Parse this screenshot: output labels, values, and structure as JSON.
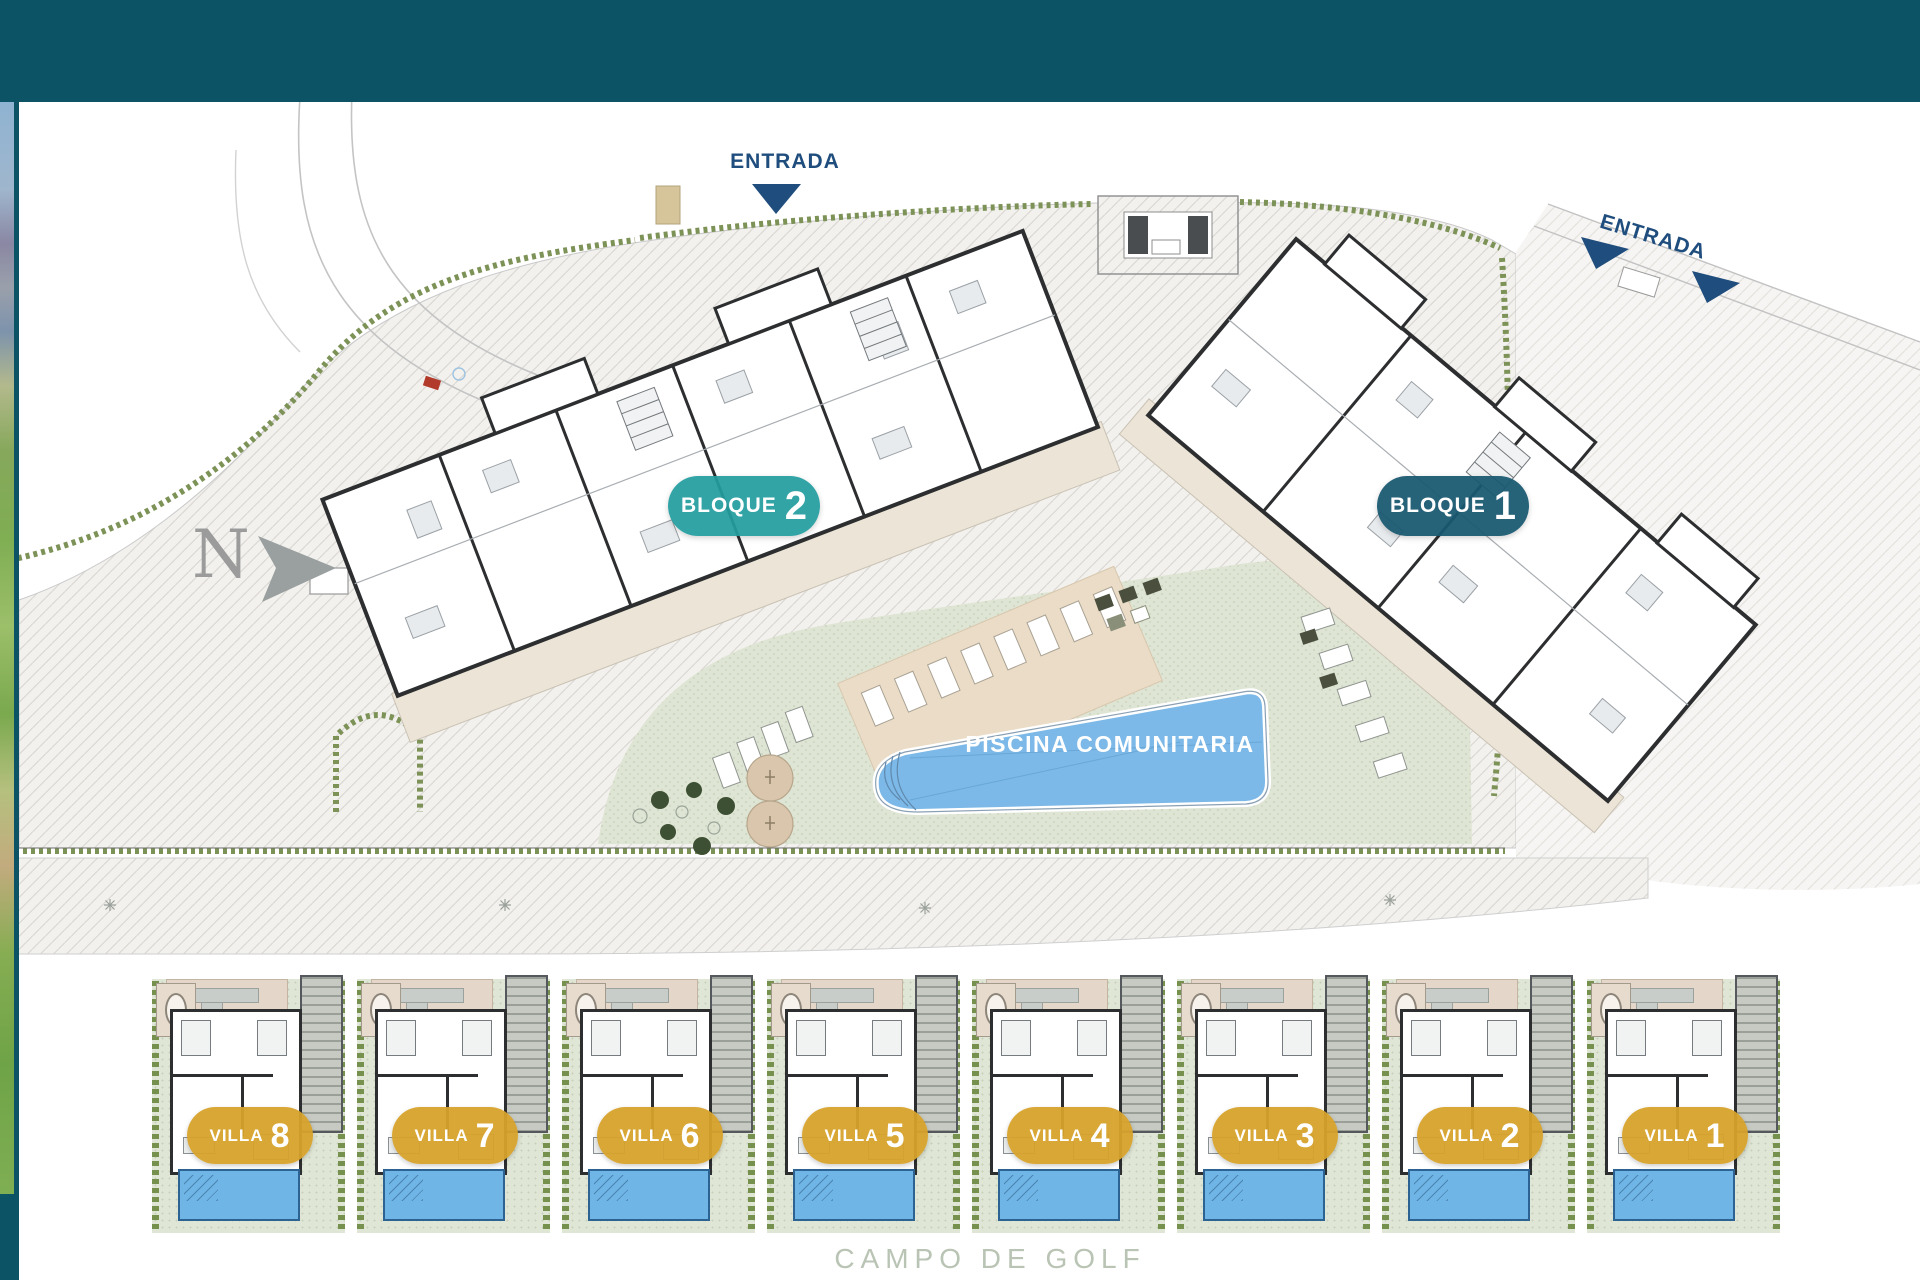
{
  "plan_title_context": "residential development site plan",
  "colors": {
    "header_teal": "#0b5365",
    "bloque2_teal": "#239d9f",
    "bloque1_petrol": "#185870",
    "villa_gold": "#d7a22b",
    "pool_blue": "#7cb9e8",
    "villa_pool_blue": "#6fb5e6",
    "entrance_navy": "#1f4d7d",
    "lawn_green": "#dfe5d4",
    "golf_text_green": "#b9c4b4"
  },
  "plan": {
    "entrances": [
      {
        "label": "ENTRADA"
      },
      {
        "label": "ENTRADA"
      }
    ],
    "north": {
      "label": "N"
    },
    "blocks": [
      {
        "label": "BLOQUE",
        "number": "2"
      },
      {
        "label": "BLOQUE",
        "number": "1"
      }
    ],
    "pool": {
      "label": "PISCINA COMUNITARIA"
    },
    "villas": [
      {
        "label": "VILLA",
        "number": "8"
      },
      {
        "label": "VILLA",
        "number": "7"
      },
      {
        "label": "VILLA",
        "number": "6"
      },
      {
        "label": "VILLA",
        "number": "5"
      },
      {
        "label": "VILLA",
        "number": "4"
      },
      {
        "label": "VILLA",
        "number": "3"
      },
      {
        "label": "VILLA",
        "number": "2"
      },
      {
        "label": "VILLA",
        "number": "1"
      }
    ],
    "golf": {
      "label": "CAMPO DE GOLF"
    }
  }
}
